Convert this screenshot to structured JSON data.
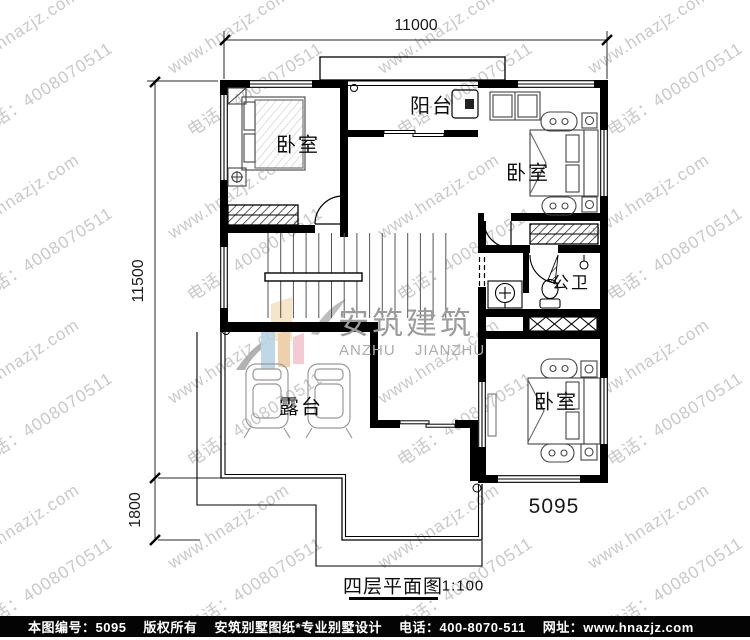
{
  "watermark": {
    "site": "www.hnazjz.com",
    "phone": "电话：4008070511",
    "color": "#c9c9c9"
  },
  "logo": {
    "cn": "安筑建筑",
    "en": "ANZHU JIANZHU"
  },
  "dimensions": {
    "top": "11000",
    "left": "11500",
    "left_lower": "1800"
  },
  "rooms": {
    "bedroom": "卧室",
    "balcony": "阳台",
    "bathroom": "公卫",
    "terrace": "露台"
  },
  "plan_number": "5095",
  "title": {
    "name": "四层平面图",
    "scale": "1:100"
  },
  "footer": {
    "items": [
      "本图编号：5095",
      "版权所有",
      "安筑别墅图纸*专业别墅设计",
      "电话：400-8070-511",
      "网址：www.hnazjz.com"
    ]
  }
}
